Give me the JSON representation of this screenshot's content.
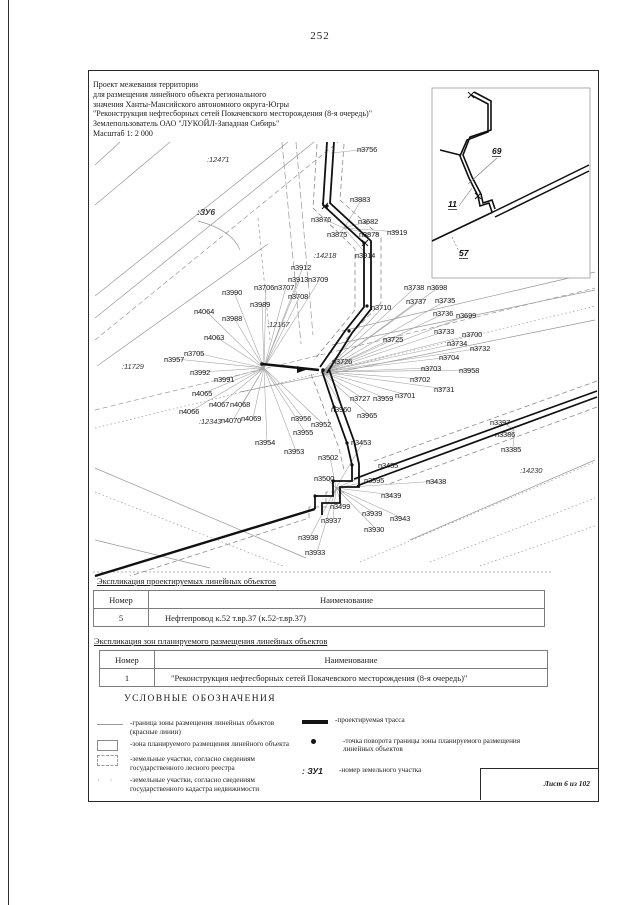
{
  "page": {
    "number": "252",
    "sheet_label": "Лист 6 из 102"
  },
  "header": {
    "lines": [
      "Проект межевания территории",
      "для размещения линейного объекта регионального",
      "значения Ханты-Мансийского автономного округа-Югры",
      "\"Реконструкция нефтесборных сетей Покачевского месторождения (8-я очередь)\"",
      "Землепользователь ОАО \"ЛУКОЙЛ-Западная Сибирь\"",
      "Масштаб 1: 2 000"
    ]
  },
  "map": {
    "hubs": {
      "t": [
        331,
        153
      ],
      "n": [
        344,
        228
      ],
      "w": [
        264,
        368
      ],
      "e": [
        322,
        372
      ],
      "s": [
        336,
        488
      ],
      "se": [
        514,
        430
      ]
    },
    "inset_labels": [
      {
        "text": "69",
        "x": 492,
        "y": 147
      },
      {
        "text": "11",
        "x": 448,
        "y": 200
      },
      {
        "text": "57",
        "x": 459,
        "y": 249
      }
    ],
    "labels": [
      {
        "t": ":12471",
        "x": 207,
        "y": 155,
        "i": 1
      },
      {
        "t": ":ЗУ6",
        "x": 197,
        "y": 207,
        "i": 1,
        "b": 1
      },
      {
        "t": "п3756",
        "x": 357,
        "y": 145,
        "h": "t"
      },
      {
        "t": "п3883",
        "x": 350,
        "y": 195,
        "h": "n"
      },
      {
        "t": "п3876",
        "x": 311,
        "y": 215,
        "h": "n"
      },
      {
        "t": "п3682",
        "x": 358,
        "y": 217,
        "h": "n"
      },
      {
        "t": "п3875",
        "x": 327,
        "y": 230,
        "h": "n"
      },
      {
        "t": "п3878",
        "x": 359,
        "y": 230,
        "h": "n"
      },
      {
        "t": "п3919",
        "x": 387,
        "y": 228,
        "h": "n"
      },
      {
        "t": ":14218",
        "x": 314,
        "y": 251,
        "i": 1
      },
      {
        "t": "п3914",
        "x": 355,
        "y": 251,
        "h": "n"
      },
      {
        "t": "п3912",
        "x": 291,
        "y": 263,
        "h": "w"
      },
      {
        "t": "п3913",
        "x": 288,
        "y": 275,
        "h": "w"
      },
      {
        "t": "п3709",
        "x": 308,
        "y": 275,
        "h": "w"
      },
      {
        "t": "п3706",
        "x": 254,
        "y": 283,
        "h": "w"
      },
      {
        "t": "п3707",
        "x": 274,
        "y": 283,
        "h": "w"
      },
      {
        "t": "п3708",
        "x": 288,
        "y": 292,
        "h": "w"
      },
      {
        "t": "п3990",
        "x": 222,
        "y": 288,
        "h": "w"
      },
      {
        "t": "п3989",
        "x": 250,
        "y": 300,
        "h": "w"
      },
      {
        "t": "п4064",
        "x": 194,
        "y": 307,
        "h": "w"
      },
      {
        "t": "п3988",
        "x": 222,
        "y": 314,
        "h": "w"
      },
      {
        "t": ":12167",
        "x": 267,
        "y": 320,
        "i": 1
      },
      {
        "t": "п4063",
        "x": 204,
        "y": 333,
        "h": "w"
      },
      {
        "t": "п3705",
        "x": 184,
        "y": 349,
        "h": "w"
      },
      {
        "t": "п3957",
        "x": 164,
        "y": 355,
        "h": "w"
      },
      {
        "t": ":11729",
        "x": 122,
        "y": 362,
        "i": 1
      },
      {
        "t": "п3992",
        "x": 190,
        "y": 368,
        "h": "w"
      },
      {
        "t": "п3991",
        "x": 214,
        "y": 375,
        "h": "w"
      },
      {
        "t": "п4065",
        "x": 192,
        "y": 389,
        "h": "w"
      },
      {
        "t": "п4067",
        "x": 209,
        "y": 400,
        "h": "w"
      },
      {
        "t": "п4068",
        "x": 230,
        "y": 400,
        "h": "w"
      },
      {
        "t": "п4066",
        "x": 179,
        "y": 407,
        "h": "w"
      },
      {
        "t": ":12343",
        "x": 199,
        "y": 417,
        "i": 1
      },
      {
        "t": "п4070",
        "x": 221,
        "y": 416,
        "h": "w"
      },
      {
        "t": "п4069",
        "x": 241,
        "y": 414,
        "h": "w"
      },
      {
        "t": "п3954",
        "x": 255,
        "y": 438,
        "h": "w"
      },
      {
        "t": "п3953",
        "x": 284,
        "y": 447,
        "h": "w"
      },
      {
        "t": "п3955",
        "x": 293,
        "y": 428,
        "h": "w"
      },
      {
        "t": "п3956",
        "x": 291,
        "y": 414,
        "h": "w"
      },
      {
        "t": "п3952",
        "x": 311,
        "y": 420,
        "h": "w"
      },
      {
        "t": "п3738",
        "x": 404,
        "y": 283,
        "h": "e"
      },
      {
        "t": "п3698",
        "x": 427,
        "y": 283,
        "h": "e"
      },
      {
        "t": "п3737",
        "x": 406,
        "y": 297,
        "h": "e"
      },
      {
        "t": "п3735",
        "x": 435,
        "y": 296,
        "h": "e"
      },
      {
        "t": "п3710",
        "x": 371,
        "y": 303,
        "h": "e"
      },
      {
        "t": "п3736",
        "x": 433,
        "y": 309,
        "h": "e"
      },
      {
        "t": "п3699",
        "x": 456,
        "y": 311,
        "h": "e"
      },
      {
        "t": "п3733",
        "x": 434,
        "y": 327,
        "h": "e"
      },
      {
        "t": "п3700",
        "x": 462,
        "y": 330,
        "h": "e"
      },
      {
        "t": "п3725",
        "x": 383,
        "y": 335,
        "h": "e"
      },
      {
        "t": "п3734",
        "x": 447,
        "y": 339,
        "h": "e"
      },
      {
        "t": "п3732",
        "x": 470,
        "y": 344,
        "h": "e"
      },
      {
        "t": "п3726",
        "x": 332,
        "y": 357,
        "h": "e"
      },
      {
        "t": "п3704",
        "x": 439,
        "y": 353,
        "h": "e"
      },
      {
        "t": "п3703",
        "x": 421,
        "y": 364,
        "h": "e"
      },
      {
        "t": "п3958",
        "x": 459,
        "y": 366,
        "h": "e"
      },
      {
        "t": "п3702",
        "x": 410,
        "y": 375,
        "h": "e"
      },
      {
        "t": "п3731",
        "x": 434,
        "y": 385,
        "h": "e"
      },
      {
        "t": "п3727",
        "x": 350,
        "y": 394,
        "h": "e"
      },
      {
        "t": "п3959",
        "x": 373,
        "y": 394,
        "h": "e"
      },
      {
        "t": "п3701",
        "x": 395,
        "y": 391,
        "h": "e"
      },
      {
        "t": "п3960",
        "x": 331,
        "y": 405,
        "h": "e"
      },
      {
        "t": "п3965",
        "x": 357,
        "y": 411,
        "h": "e"
      },
      {
        "t": "п3453",
        "x": 351,
        "y": 438,
        "h": "s"
      },
      {
        "t": "п3502",
        "x": 318,
        "y": 453,
        "h": "s"
      },
      {
        "t": "п3455",
        "x": 378,
        "y": 461,
        "h": "s"
      },
      {
        "t": "п3500",
        "x": 314,
        "y": 474,
        "h": "s"
      },
      {
        "t": "п3595",
        "x": 364,
        "y": 476,
        "h": "s"
      },
      {
        "t": "п3438",
        "x": 426,
        "y": 477,
        "h": "s"
      },
      {
        "t": "п3439",
        "x": 381,
        "y": 491,
        "h": "s"
      },
      {
        "t": "п3499",
        "x": 330,
        "y": 502,
        "h": "s"
      },
      {
        "t": "п3939",
        "x": 362,
        "y": 509,
        "h": "s"
      },
      {
        "t": "п3937",
        "x": 321,
        "y": 516,
        "h": "s"
      },
      {
        "t": "п3943",
        "x": 390,
        "y": 514,
        "h": "s"
      },
      {
        "t": "п3930",
        "x": 364,
        "y": 525,
        "h": "s"
      },
      {
        "t": "п3938",
        "x": 298,
        "y": 533,
        "h": "s"
      },
      {
        "t": "п3933",
        "x": 305,
        "y": 548,
        "h": "s"
      },
      {
        "t": "п3397",
        "x": 490,
        "y": 418,
        "h": "se"
      },
      {
        "t": "п3386",
        "x": 495,
        "y": 430,
        "h": "se"
      },
      {
        "t": "п3385",
        "x": 501,
        "y": 445,
        "h": "se"
      },
      {
        "t": ":14230",
        "x": 520,
        "y": 466,
        "i": 1
      }
    ]
  },
  "tables": [
    {
      "caption": "Экспликация проектируемых линейных объектов",
      "headers": [
        "Номер",
        "Наименование"
      ],
      "rows": [
        [
          "5",
          "Нефтепровод к.52 т.вр.37 (к.52-т.вр.37)"
        ]
      ]
    },
    {
      "caption": "Экспликация зон планируемого размещения линейных объектов",
      "headers": [
        "Номер",
        "Наименование"
      ],
      "rows": [
        [
          "1",
          "\"Реконструкция нефтесборных сетей Покачевского месторождения (8-я очередь)\""
        ]
      ]
    }
  ],
  "legend": {
    "title": "УСЛОВНЫЕ ОБОЗНАЧЕНИЯ",
    "left": [
      {
        "symbol": "red-line",
        "text": "-граница зоны размещения линейных объектов (красные линии)"
      },
      {
        "symbol": "rect",
        "text": "-зона планируемого размещения линейного объекта"
      },
      {
        "symbol": "dashed-rect",
        "text": "-земельные участки, согласно сведениям государственного лесного реестра"
      },
      {
        "symbol": "dots",
        "text": "-земельные участки, согласно сведениям государственного кадастра недвижимости"
      }
    ],
    "right": [
      {
        "symbol": "thick-line",
        "text": "-проектируемая трасса"
      },
      {
        "symbol": "dot",
        "text": "-точка поворота границы зоны планируемого размещения линейных объектов"
      },
      {
        "symbol": "zu-label",
        "label": ": ЗУ1",
        "text": "-номер земельного участка"
      }
    ]
  }
}
